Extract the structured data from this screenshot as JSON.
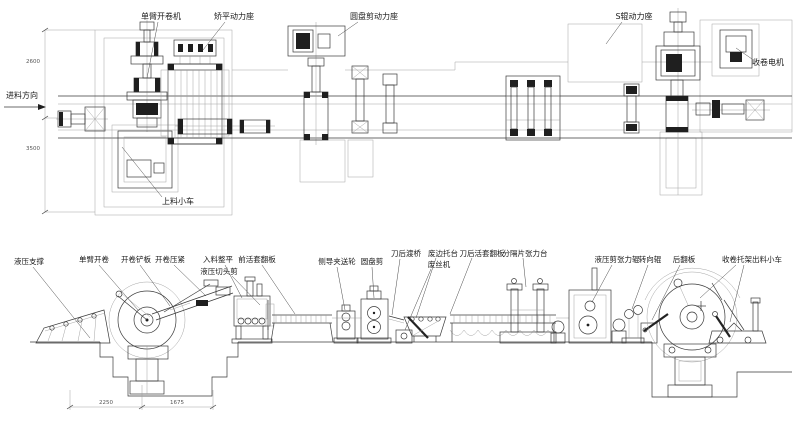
{
  "colors": {
    "ink": "#3a3a3a",
    "light_line": "#9b9b9b",
    "dark_fill": "#1f1f1f",
    "background": "#ffffff"
  },
  "top_view": {
    "labels": {
      "uncoiler": "单臂开卷机",
      "leveler_power": "矫平动力座",
      "disc_shear_power": "圆盘剪动力座",
      "s_roll_power": "S辊动力座",
      "rewind_motor": "收卷电机",
      "loading_trolley": "上料小车",
      "feed_direction": "进料方向"
    },
    "dimensions": {
      "upper": "2600",
      "lower": "3500"
    }
  },
  "bottom_view": {
    "labels": {
      "hydraulic_support": "液压支撑",
      "single_arm_uncoiler": "单臂开卷",
      "uncoiler_shovel": "开卷铲板",
      "uncoiler_press": "开卷压紧",
      "entry_leveler": "入料整平",
      "hydraulic_crop_shear": "液压切头剪",
      "front_loop_flap": "前活套翻板",
      "side_guide_pinch_roll": "侧导夹送轮",
      "disc_shear": "圆盘剪",
      "post_knife_bridge": "刀后渡桥",
      "scrap_edge_table": "废边托台",
      "scrap_winder": "废丝机",
      "post_knife_loop_flap": "刀后活套翻板",
      "separator_tension_table": "分隔片张力台",
      "hydraulic_shear_tension_roll": "液压剪张力辊",
      "turning_roll": "转向辊",
      "rear_flap": "后翻板",
      "recoil_cradle_trolley": "收卷托架出料小车"
    },
    "dimensions": {
      "left": "2250",
      "right": "1675"
    }
  }
}
